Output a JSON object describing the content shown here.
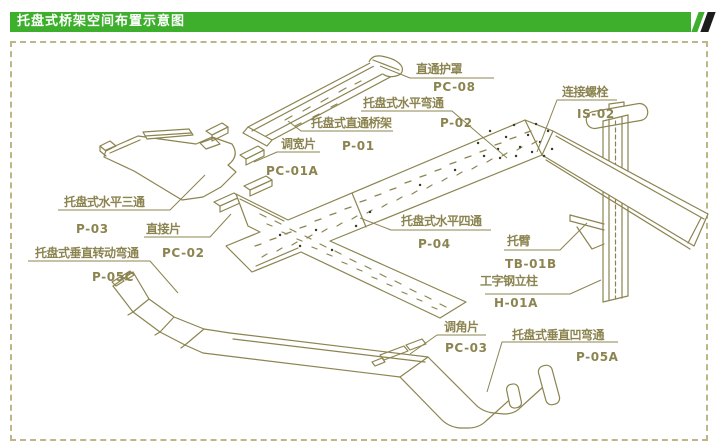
{
  "header": {
    "title": "托盘式桥架空间布置示意图"
  },
  "colors": {
    "green": "#3daf2d",
    "stripe-dark": "#1c1c1c",
    "line": "#8c8450",
    "border": "#bdb787",
    "dot": "#3c3c26"
  },
  "diagram": {
    "labels": [
      {
        "name": "直通护罩",
        "code": "PC-08"
      },
      {
        "name": "托盘式水平弯通",
        "code": "P-02"
      },
      {
        "name": "连接螺栓",
        "code": "IS-02"
      },
      {
        "name": "托盘式直通桥架",
        "code": "P-01"
      },
      {
        "name": "调宽片",
        "code": "PC-01A"
      },
      {
        "name": "托盘式水平三通",
        "code": "P-03"
      },
      {
        "name": "直接片",
        "code": "PC-02"
      },
      {
        "name": "托盘式垂直转动弯通",
        "code": "P-05C"
      },
      {
        "name": "托盘式水平四通",
        "code": "P-04"
      },
      {
        "name": "托臂",
        "code": "TB-01B"
      },
      {
        "name": "工字钢立柱",
        "code": "H-01A"
      },
      {
        "name": "调角片",
        "code": "PC-03"
      },
      {
        "name": "托盘式垂直凹弯通",
        "code": "P-05A"
      }
    ]
  }
}
